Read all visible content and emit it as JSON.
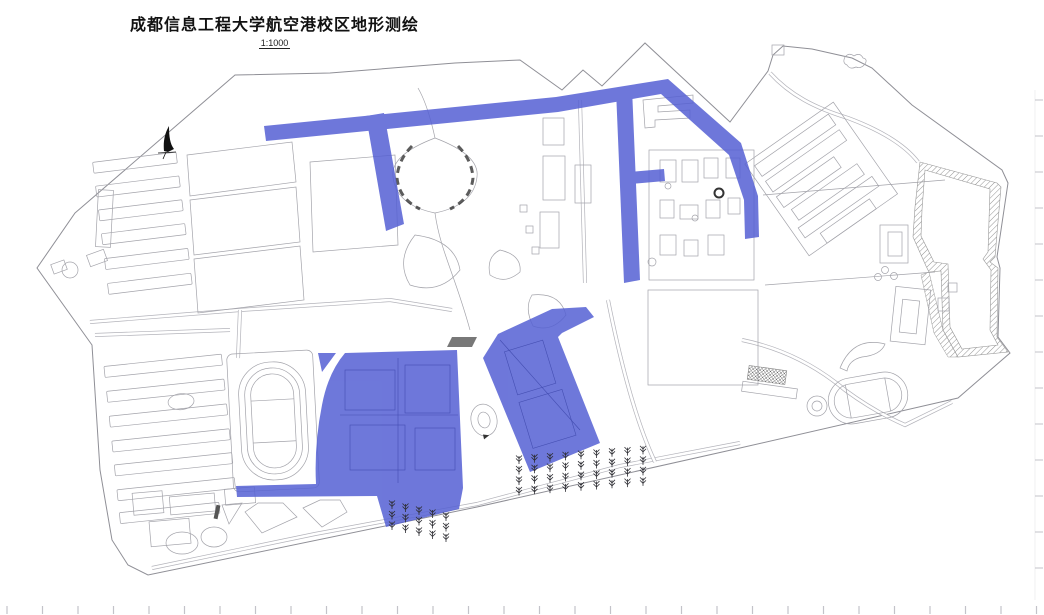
{
  "header": {
    "title": "成都信息工程大学航空港校区地形测绘",
    "scale": "1:1000"
  },
  "map": {
    "background": "#ffffff",
    "line_color": "#a3a3aa",
    "boundary_color": "#8f8f96",
    "dark_detail_color": "#333333",
    "highlight_color": "#5560d4",
    "highlighted_regions": [
      "north-perimeter-road",
      "northwest-branch-road",
      "central-vertical-road",
      "east-branch-stub-road",
      "northeast-diagonal-road",
      "southwest-building-block",
      "south-central-building-block",
      "south-connector-strip",
      "small-west-wedge"
    ],
    "features": [
      "north-arrow",
      "central-oval-lawn",
      "traffic-circle",
      "west-athletics-track",
      "east-athletics-track",
      "northwest-dormitory-rows",
      "southwest-dormitory-rows",
      "northeast-building-cluster",
      "far-east-building-cluster",
      "east-pond-embankment",
      "south-tree-rows",
      "grandstand"
    ],
    "ruler_ticks": {
      "bottom": {
        "count": 30,
        "start_x": 7,
        "step": 35.5,
        "y": 606,
        "len": 8
      },
      "right": {
        "count": 14,
        "start_y": 100,
        "step": 36,
        "x": 1035,
        "len": 8
      }
    },
    "tree_grids": [
      {
        "x0": 392,
        "y0": 501,
        "cols": 5,
        "rows": 3,
        "dx": 13.5,
        "dy": 10.5,
        "col_shift": 3
      },
      {
        "x0": 519,
        "y0": 456,
        "cols": 9,
        "rows": 4,
        "dx": 15.5,
        "dy": 10.5,
        "col_shift": -1.2
      }
    ]
  }
}
